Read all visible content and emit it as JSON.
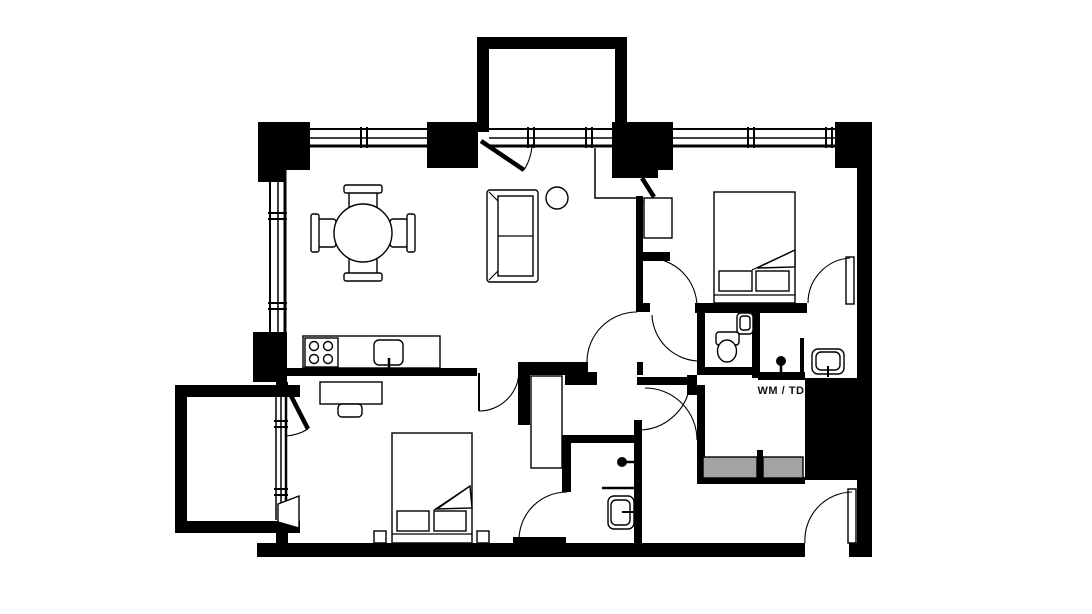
{
  "plan": {
    "labels": {
      "wm_td": "WM / TD"
    },
    "colors": {
      "walls": "#000000",
      "appliances": "#a3a3a3",
      "floor": "#ffffff",
      "label_text": "#111111"
    },
    "fixtures": [
      "dining-table",
      "dining-chair",
      "sofa",
      "plant",
      "double-bed",
      "pillow",
      "blanket-fold",
      "wardrobe",
      "desk",
      "desk-chair",
      "kitchen-counter",
      "hob",
      "kitchen-sink",
      "toilet",
      "hand-basin",
      "washbasin",
      "shower-head",
      "shower-screen",
      "washing-machine",
      "tumble-dryer",
      "tall-cupboard",
      "balcony",
      "window",
      "door-swing",
      "entrance-door",
      "nightstand"
    ]
  }
}
